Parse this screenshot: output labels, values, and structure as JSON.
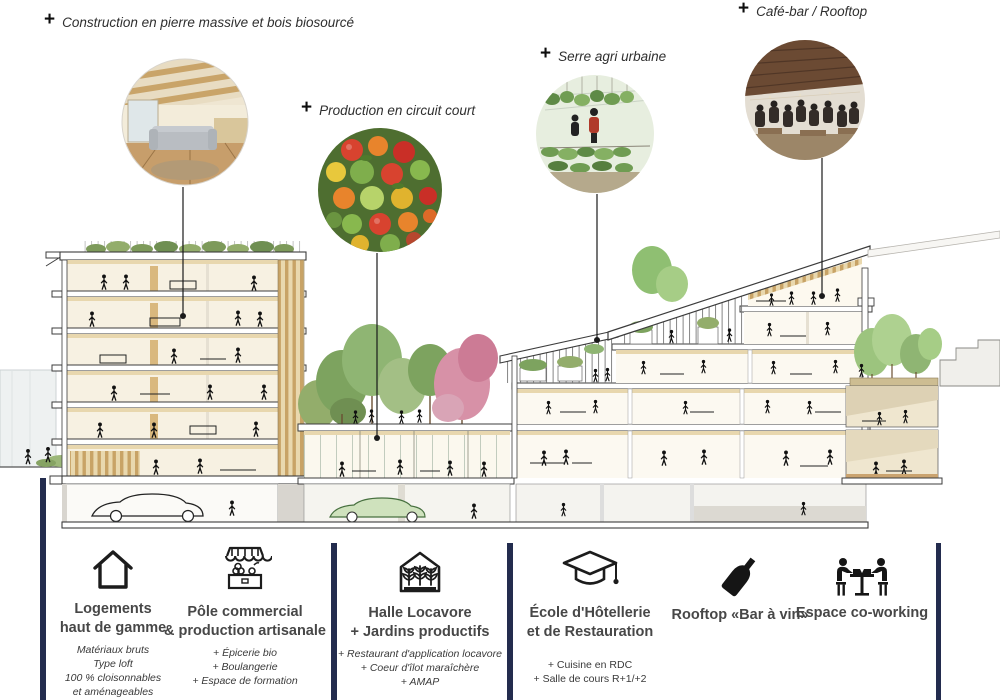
{
  "annotations": [
    {
      "marker": "+",
      "label": "Construction en pierre massive et bois biosourcé"
    },
    {
      "marker": "+",
      "label": "Production en circuit court"
    },
    {
      "marker": "+",
      "label": "Serre agri urbaine"
    },
    {
      "marker": "+",
      "label": "Café-bar / Rooftop"
    }
  ],
  "illustration": {
    "photos": [
      "loft-interior",
      "fresh-vegetables",
      "urban-greenhouse",
      "rooftop-bar"
    ],
    "buildings": [
      "left-residential-building",
      "courtyard-and-market-hall",
      "right-stepped-building",
      "right-annex-terrace"
    ]
  },
  "legend": {
    "items": [
      {
        "icon": "house-icon",
        "title": [
          "Logements",
          "haut de gamme"
        ],
        "details": [
          "Matériaux bruts",
          "Type loft",
          "100 % cloisonnables",
          "et aménageables"
        ]
      },
      {
        "icon": "market-stall-icon",
        "title": [
          "Pôle commercial",
          "& production artisanale"
        ],
        "details": [
          "+ Épicerie bio",
          "+ Boulangerie",
          "+ Espace de formation"
        ]
      },
      {
        "icon": "greenhouse-icon",
        "title": [
          "Halle Locavore",
          "+ Jardins productifs"
        ],
        "details": [
          "+ Restaurant d'application locavore",
          "+ Coeur d'îlot maraîchère",
          "+ AMAP"
        ]
      },
      {
        "icon": "graduation-cap-icon",
        "title": [
          "École d'Hôtellerie",
          "et de Restauration"
        ],
        "details": [
          "+ Cuisine en RDC",
          "+ Salle de cours R+1/+2"
        ]
      },
      {
        "icon": "wine-bottle-icon",
        "title": [
          "Rooftop «Bar à vin»"
        ],
        "details": []
      },
      {
        "icon": "co-working-icon",
        "title": [
          "Espace co-working"
        ],
        "details": []
      }
    ]
  },
  "colors": {
    "divider": "#232c4e",
    "wood": "#d9b87e",
    "foliage": "#8fb573",
    "blossom": "#d791a7",
    "ink": "#1a1a1a"
  }
}
